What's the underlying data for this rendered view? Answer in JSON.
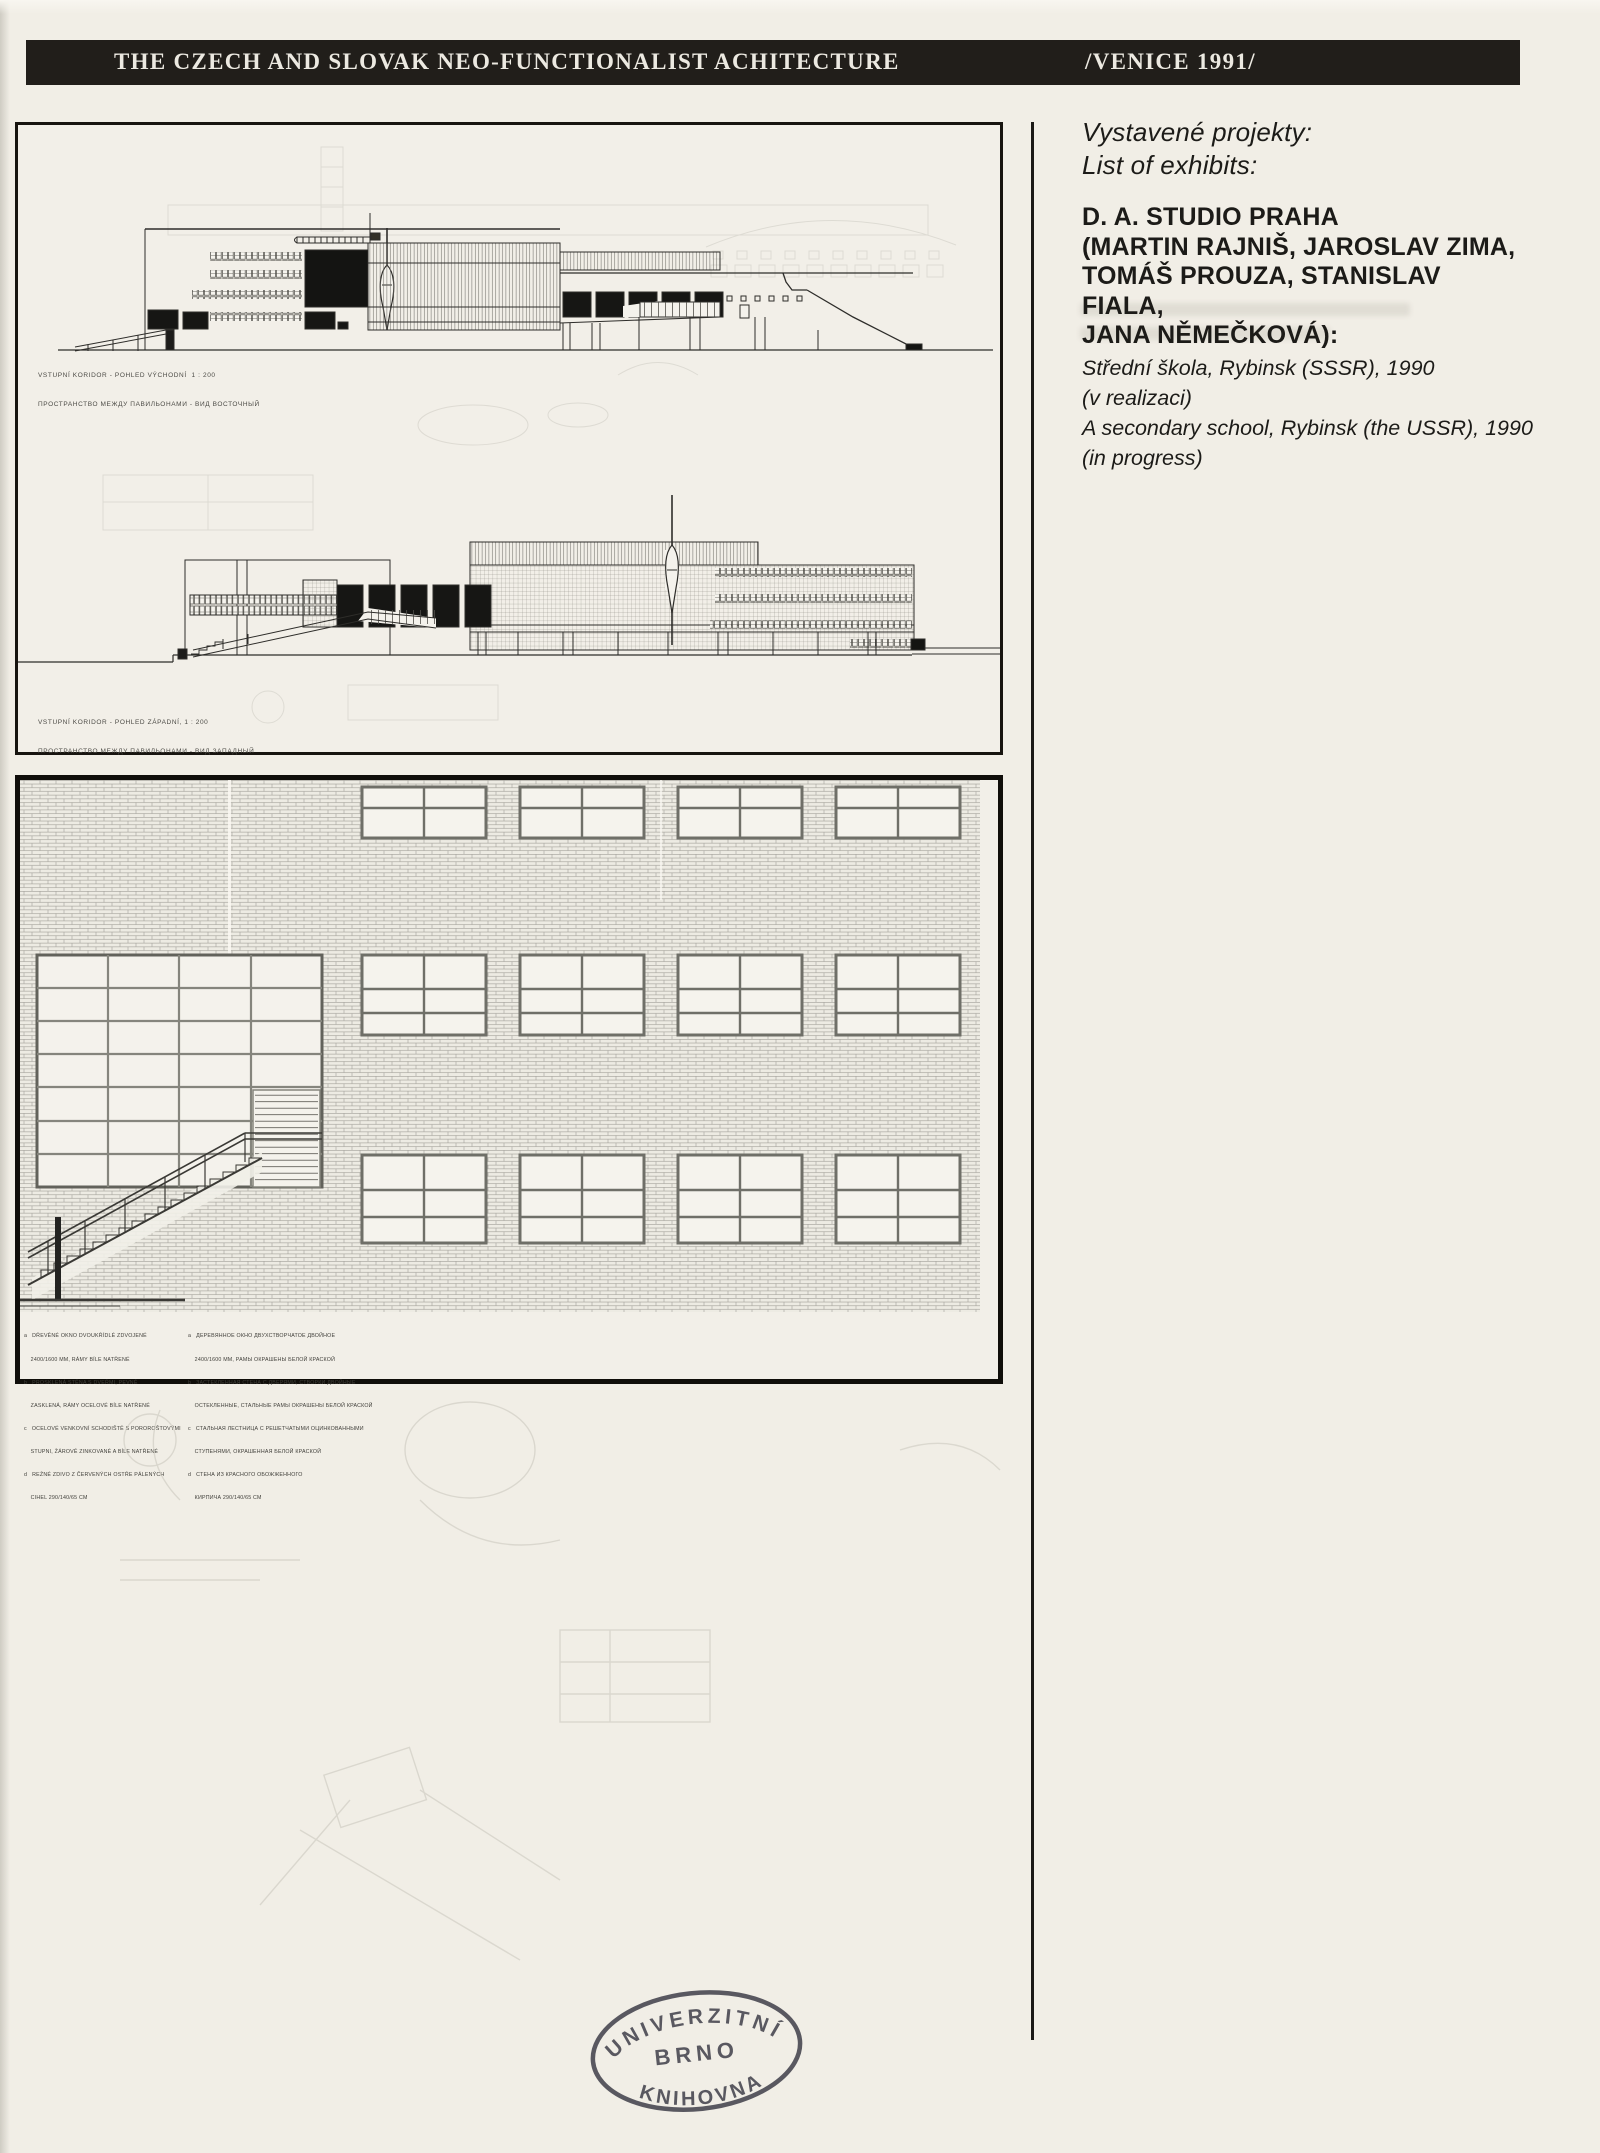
{
  "header": {
    "title": "THE CZECH AND SLOVAK NEO-FUNCTIONALIST ACHITECTURE",
    "venue": "/VENICE 1991/"
  },
  "exhibits": {
    "heading_cs": "Vystavené projekty:",
    "heading_en": "List of exhibits:",
    "studio_line1": "D. A. STUDIO PRAHA",
    "studio_line2": "(MARTIN RAJNIŠ, JAROSLAV ZIMA,",
    "studio_line3": "TOMÁŠ PROUZA, STANISLAV",
    "studio_line4": "FIALA,",
    "studio_line5": "JANA NĚMEČKOVÁ):",
    "project_line1": "Střední škola, Rybinsk (SSSR), 1990",
    "project_line2": "(v realizaci)",
    "project_line3": "A secondary school, Rybinsk (the USSR), 1990",
    "project_line4": "(in progress)"
  },
  "drawings": {
    "east": {
      "caption_cs": "VSTUPNÍ KORIDOR - POHLED VÝCHODNÍ  1 : 200",
      "caption_ru": "ПРОСТРАНСТВО МЕЖДУ ПАВИЛЬОНАМИ - ВИД ВОСТОЧНЫЙ"
    },
    "west": {
      "caption_cs": "VSTUPNÍ KORIDOR - POHLED ZÁPADNÍ, 1 : 200",
      "caption_ru": "ПРОСТРАНСТВО МЕЖДУ ПАВИЛЬОНАМИ - ВИД ЗАПАДНЫЙ"
    }
  },
  "legend": {
    "left": [
      "a   DŘEVĚNÉ OKNO DVOUKŘÍDLÉ ZDVOJENÉ",
      "    2400/1600 MM, RÁMY BÍLE NATŘENÉ",
      "b   PROSKLENÁ STĚNA S DVEŘMI, PEVNĚ",
      "    ZASKLENÁ, RÁMY OCELOVÉ BÍLE NATŘENÉ",
      "c   OCELOVÉ VENKOVNÍ SCHODIŠTĚ S POROROŠTOVÝMI",
      "    STUPNI, ŽÁROVĚ ZINKOVANÉ A BÍLE NATŘENÉ",
      "d   REŽNÉ ZDIVO Z ČERVENÝCH OSTŘE PÁLENÝCH",
      "    CIHEL 290/140/65 CM"
    ],
    "right": [
      "a   ДЕРЕВЯННОЕ ОКНО ДВУХСТВОРЧАТОЕ ДВОЙНОЕ",
      "    2400/1600 ММ, РАМЫ ОКРАШЕНЫ БЕЛОЙ КРАСКОЙ",
      "b   ЗАСТЕКЛЕННАЯ СТЕНА С ДВЕРЯМИ, СТВОРКИ ДВОЙНЫЕ",
      "    ОСТЕКЛЕННЫЕ, СТАЛЬНЫЕ РАМЫ ОКРАШЕНЫ БЕЛОЙ КРАСКОЙ",
      "c   СТАЛЬНАЯ ЛЕСТНИЦА С РЕШЕТЧАТЫМИ ОЦИНКОВАННЫМИ",
      "    СТУПЕНЯМИ, ОКРАШЕННАЯ БЕЛОЙ КРАСКОЙ",
      "d   СТЕНА ИЗ КРАСНОГО ОБОЖЖЕННОГО",
      "    КИРПИЧА 290/140/65 СМ"
    ]
  },
  "stamp": {
    "top": "UNIVERZITNÍ",
    "middle": "BRNO",
    "bottom": "KNIHOVNA"
  },
  "colors": {
    "paper": "#f1eee6",
    "bar": "#211e1a",
    "ink": "#1c1b18",
    "drawing_ink": "#2e2d2a",
    "stamp_ink": "#45444e"
  }
}
